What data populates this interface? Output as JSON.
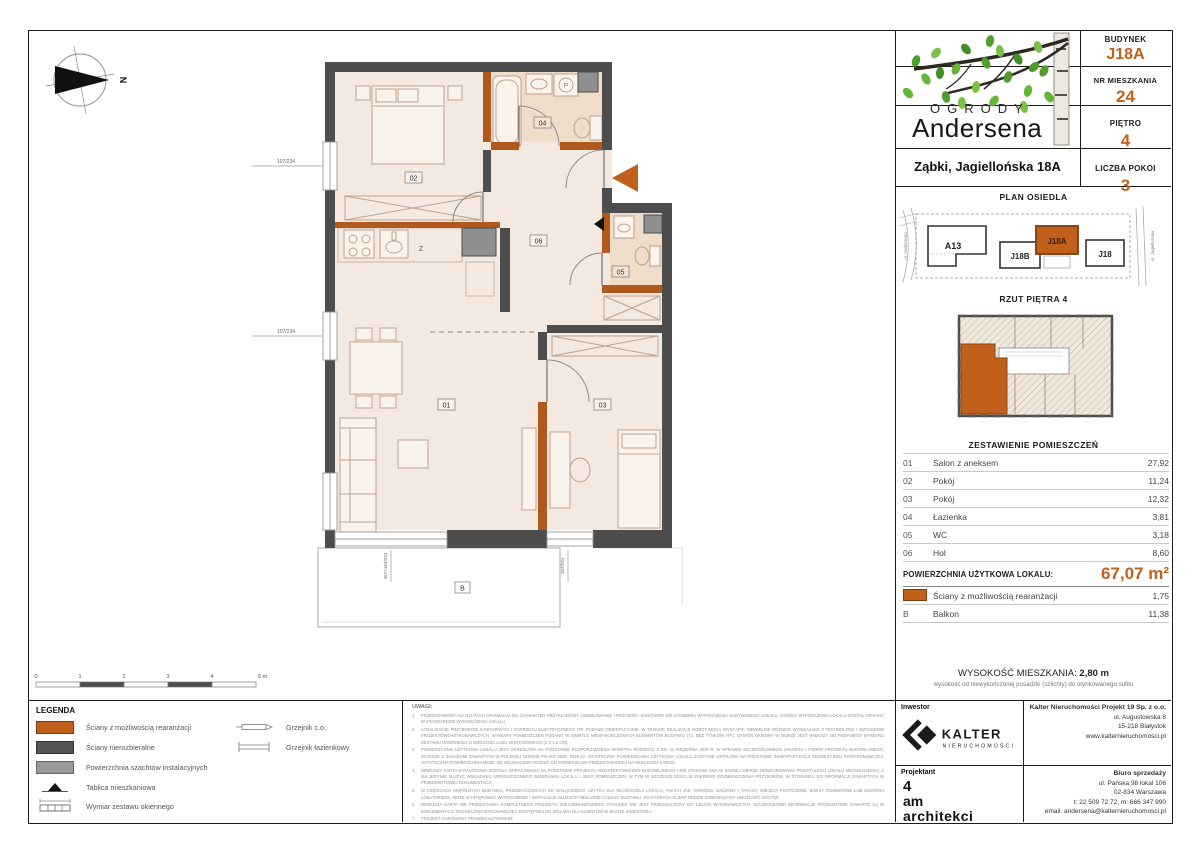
{
  "header": {
    "logo_top": "OGRODY",
    "logo_bottom": "Andersena",
    "address": "Ząbki, Jagiellońska 18A",
    "info": [
      {
        "label": "BUDYNEK",
        "value": "J18A"
      },
      {
        "label": "NR MIESZKANIA",
        "value": "24"
      },
      {
        "label": "PIĘTRO",
        "value": "4"
      },
      {
        "label": "LICZBA POKOI",
        "value": "3"
      }
    ]
  },
  "site_plan": {
    "title": "PLAN OSIEDLA",
    "buildings": [
      "A13",
      "J18B",
      "J18A",
      "J18"
    ],
    "highlighted": "J18A",
    "street_left": "ul. Andersena",
    "street_right": "ul. Jagiellońska"
  },
  "floor_plan_mini": {
    "title": "RZUT PIĘTRA 4"
  },
  "rooms": {
    "title": "ZESTAWIENIE POMIESZCZEŃ",
    "rows": [
      {
        "no": "01",
        "name": "Salon z aneksem",
        "area": "27,92"
      },
      {
        "no": "02",
        "name": "Pokój",
        "area": "11,24"
      },
      {
        "no": "03",
        "name": "Pokój",
        "area": "12,32"
      },
      {
        "no": "04",
        "name": "Łazienka",
        "area": "3,81"
      },
      {
        "no": "05",
        "name": "WC",
        "area": "3,18"
      },
      {
        "no": "06",
        "name": "Hol",
        "area": "8,60"
      }
    ],
    "total_label": "POWIERZCHNIA UŻYTKOWA LOKALU:",
    "total_value": "67,07 m²",
    "extra": [
      {
        "marker": "",
        "name": "Ściany z możliwością rearanżacji",
        "area": "1,75"
      },
      {
        "marker": "B",
        "name": "Balkon",
        "area": "11,38"
      }
    ]
  },
  "height": {
    "label": "WYSOKOŚĆ MIESZKANIA:",
    "value": "2,80 m",
    "note": "wysokość od niewykończonej posadzki (szlichty) do otynkowanego sufitu"
  },
  "legend": {
    "title": "LEGENDA",
    "items": [
      {
        "label": "Ściany z możliwością rearanżacji"
      },
      {
        "label": "Ściany nierozbieralne"
      },
      {
        "label": "Powierzchnia szachtów instalacyjnych"
      },
      {
        "label": "Tablica mieszkaniowa"
      },
      {
        "label": "Wymiar zestawu okiennego"
      }
    ],
    "items_right": [
      {
        "label": "Grzejnik c.o."
      },
      {
        "label": "Grzejnik łazienkowy"
      }
    ]
  },
  "scalebar": {
    "labels": [
      "0",
      "1",
      "2",
      "3",
      "4",
      "5 m"
    ]
  },
  "notes": {
    "title": "UWAGI:",
    "items": [
      {
        "n": "1.",
        "text": "PRZEDSTAWIONA NA RZUTACH ARANŻACJA MA CHARAKTER PRZYKŁADOWY. UMEBLOWANIE I PRZYBORY SANITARNE NIE STANOWIĄ WYPOSAŻENIA NABYWANEGO LOKALU. ZAKRES WYPOSAŻENIA LOKALU ZOSTAŁ OPISANY W STANDARDZIE WYKOŃCZENIA LOKALU."
      },
      {
        "n": "2.",
        "text": "LOKALIZACJE PRZYBORÓW SANITARNYCH I OSPRZĘTU ELEKTRYCZNEGO ITP. PODANO ORIENTACYJNIE. W TRAKCIE REALIZACJI ROBÓT MOGĄ WYSTĄPIĆ NIEWIELKIE RÓŻNICE WYNIKAJĄCE Z TECHNOLOGII I WZGLĘDÓW PROJEKTOWO-WYKONAWCZYCH. WYMIARY POMIESZCZEŃ PODANO W ŚWIETLE NIEWYKOŃCZONYCH ELEMENTÓW BUDYNKU (TJ. BEZ TYNKÓW ITP.). OTWÓR OKIENNY W MURZE JEST WIĘKSZY OD PODANEGO WYMIARU ZESTAWU OKIENNEGO O WIELKOŚĆ LUZU MONTAŻOWEGO (2 X 1,5 CM)."
      },
      {
        "n": "3.",
        "text": "POWIERZCHNIA UŻYTKOWA LOKALU JEST OKREŚLONA NA PODSTAWIE ROZPORZĄDZENIA MINISTRA ROZWOJU Z DN. 11 WRZEŚNIA 2020 R. W SPRAWIE SZCZEGÓŁOWEGO ZAKRESU I FORMY PROJEKTU BUDOWLANEGO, ZGODNIE Z ZASADAMI ZAWARTYMI W POLSKIEJ NORMIE PN-ISO 9836: 2015-12. OSTATECZNA POWIERZCHNIA UŻYTKOWA LOKALU ZOSTANIE USTALONA NA PODSTAWIE INWENTARYZACJI GEODEZYJNEJ POWYKONAWCZEJ. OSTATECZNA POWIERZCHNIA MOŻE SIĘ NIEZNACZNIE RÓŻNIĆ OD POWIERZCHNI PRZEDSTAWIONEJ NA NINIEJSZEJ KARCIE."
      },
      {
        "n": "4.",
        "text": "NINIEJSZA KARTA KATALOGOWA ZOSTAŁA OPRACOWANA NA PODSTAWIE PROJEKTU ARCHITEKTONICZNO-BUDOWLANEGO I NIE STANOWI ONA W ŻADNEJ MIERZE ODWZOROWANIA POWSTAŁEGO LOKALU MIESZKALNEGO, A MA JEDYNIE SŁUŻYĆ WSKAZANIU UPROSZCZONEGO WIZERUNKU LOKALU I JEGO POMIESZCZEŃ, W TYM W SZCZEGÓLNOŚCI W ZAKRESIE ROZMIESZCZENIA PRZYBORÓW, W STOSUNKU DO INFORMACJI ZAWARTYCH W PRZEDMIOTOWEJ DOKUMENTACJI."
      },
      {
        "n": "5.",
        "text": "W CZĘŚCIACH WSPÓLNYCH BUDYNKU, PRZEZNACZONYCH DO WYŁĄCZNEGO UŻYTKU DLA WŁAŚCICIELA LOKALU, TAKICH JAK: OGRÓDKI, BALKONY I TARASY, MIEJSCA POSTOJOWE, BOKSY ROWEROWE LUB KOMÓRKI LOKATORSKIE, MOŻE WYSTĘPOWAĆ WYPOSAŻENIE I INSTALACJE SŁUŻĄCE OBSŁUDZE CAŁEGO BUDYNKU, DO KTÓRYCH KLIENT BĘDZIE ZOBOWIĄZANY UMOŻLIWIĆ DOSTĘP."
      },
      {
        "n": "6.",
        "text": "NINIEJSZA KARTA NIE PRZEDSTAWIA KOMPLETNEGO PROJEKTU WIELOBRANŻOWEGO. RYSUNEK NIE JEST PRZEZNACZONY DO CELÓW WYKONAWCZYCH. SZCZEGÓŁOWE INFORMACJE PRODUKTOWE ZAWARTE SĄ W DOKUMENTACJI TECHNICZNO-WYKONAWCZEJ, DOSTĘPNEJ DO WGLĄDU DLA KLIENTÓW W BIURZE INWESTORA."
      },
      {
        "n": "7.",
        "text": "PROJEKT CHRONIONY PRAWEM AUTORSKIM."
      }
    ]
  },
  "contacts": {
    "investor_label": "Inwestor",
    "investor_logo_name": "KALTER",
    "investor_logo_sub": "NIERUCHOMOŚCI",
    "investor_name": "Kalter Nieruchomości Projekt 19 Sp. z o.o.",
    "investor_lines": [
      "ul. Augustowska 8",
      "15-218 Białystok",
      "www.kalternieruchomosci.pl"
    ],
    "designer_label": "Projektant",
    "designer_logo_lines": [
      "4",
      "am",
      "architekci"
    ],
    "sales_label": "Biuro sprzedaży",
    "sales_lines": [
      "ul. Pańska 98 lokal 106",
      "02-834 Warszawa",
      "t: 22 509 72 72, m: 666 347 990",
      "email: andersena@kalternieruchomosci.pl"
    ]
  },
  "plan": {
    "north_label": "N",
    "kitchen_label": "Z",
    "washer_label": "P",
    "balcony_label": "B",
    "room_tags": [
      "01",
      "02",
      "03",
      "04",
      "05",
      "06"
    ],
    "dims": {
      "left_top": "107/234",
      "left_mid": "107/234",
      "bottom_left": "267+163/234",
      "bottom_right": "167/234"
    }
  },
  "colors": {
    "accent": "#c0601a",
    "wall_dark": "#4d4d4d",
    "wall_orange": "#b1591d",
    "shaft_gray": "#8f8f8f",
    "floor": "#f4e9e0",
    "floor_dark": "#efdcc9"
  }
}
